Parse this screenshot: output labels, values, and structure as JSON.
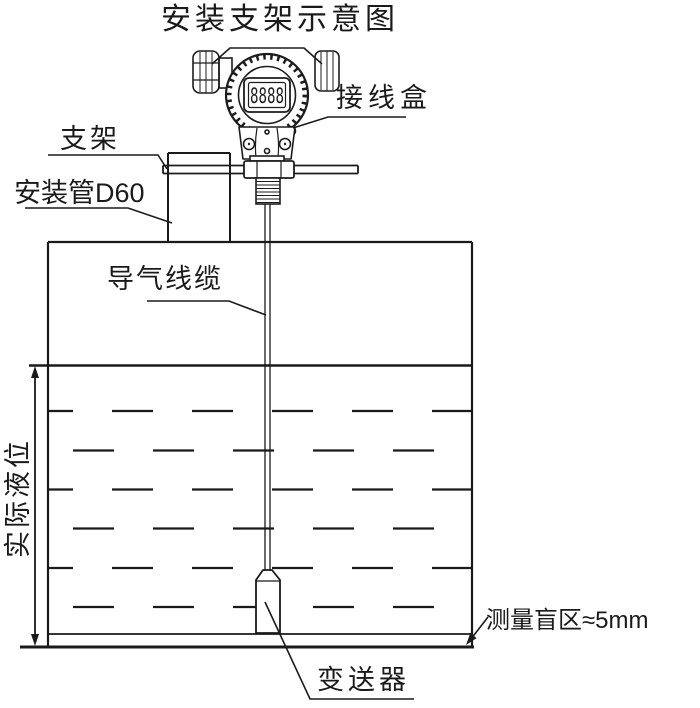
{
  "title": "安装支架示意图",
  "labels": {
    "junction_box": "接线盒",
    "bracket": "支架",
    "mounting_pipe": "安装管D60",
    "air_cable": "导气线缆",
    "actual_level": "实际液位",
    "transmitter": "变送器",
    "blind_zone": "测量盲区≈5mm"
  },
  "display": {
    "lcd_digits": "8888"
  },
  "colors": {
    "line": "#1a1a1a",
    "background": "#ffffff"
  }
}
